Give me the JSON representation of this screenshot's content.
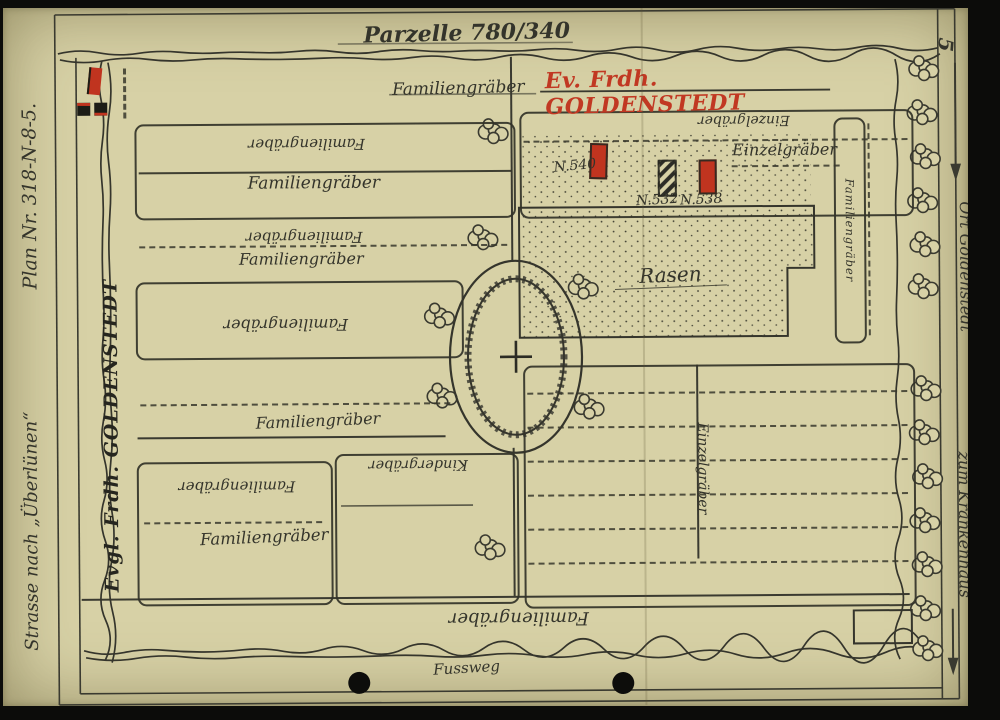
{
  "page_number": "5",
  "title": "Parzelle 780/340",
  "header": {
    "black": "Familiengräber",
    "red": "Ev. Frdh. GOLDENSTEDT"
  },
  "margins": {
    "plan_no": "Plan Nr. 318-N-8-5.",
    "street": "Strasse nach „Überlünen“",
    "cemetery_edge": "Evgl. Frdh. GOLDENSTEDT",
    "to_town": "Ort Goldenstedt",
    "to_hospital": "zum Krankenhaus"
  },
  "labels": {
    "familiengraeber": "Familiengräber",
    "einzelgraeber": "Einzelgräber",
    "kindergraeber": "Kindergräber",
    "rasen": "Rasen",
    "fussweg": "Fussweg"
  },
  "graves": [
    {
      "no": "N.540",
      "marker": "red"
    },
    {
      "no": "N.532",
      "marker": "black-hatched"
    },
    {
      "no": "N.538",
      "marker": "red"
    }
  ],
  "colors": {
    "red": "#c13822",
    "ink": "#34342b",
    "paper": "#d7d1a6"
  }
}
